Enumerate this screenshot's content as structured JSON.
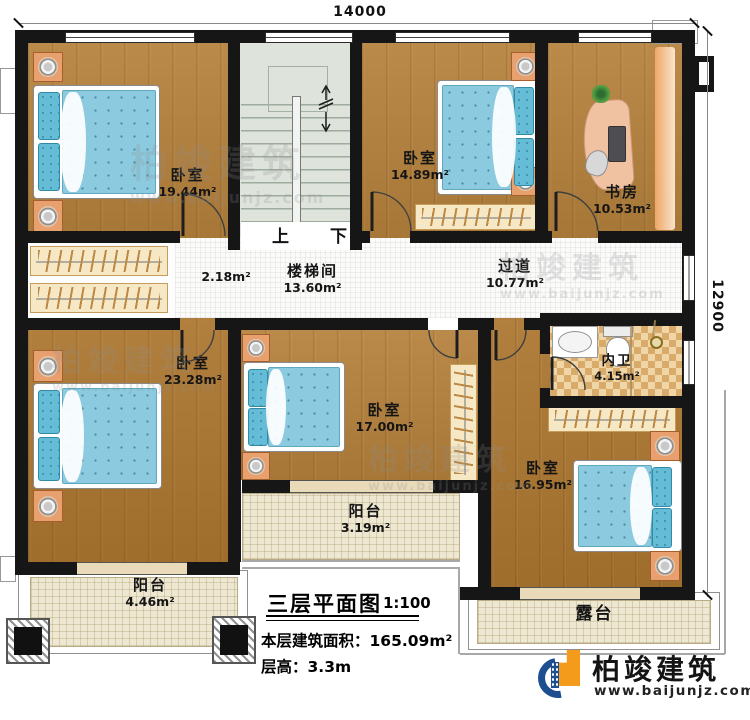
{
  "plan": {
    "dimensions": {
      "width_mm": "14000",
      "height_mm": "12900"
    },
    "rooms": {
      "bedroom_top_left": {
        "name": "卧室",
        "area": "19.44m²"
      },
      "bedroom_top_right": {
        "name": "卧室",
        "area": "14.89m²"
      },
      "study": {
        "name": "书房",
        "area": "10.53m²"
      },
      "stairwell": {
        "name": "楼梯间",
        "area": "13.60m²"
      },
      "hall": {
        "area": "2.18m²"
      },
      "corridor": {
        "name": "过道",
        "area": "10.77m²"
      },
      "bedroom_left": {
        "name": "卧室",
        "area": "23.28m²"
      },
      "bedroom_center": {
        "name": "卧室",
        "area": "17.00m²"
      },
      "bathroom": {
        "name": "内卫",
        "area": "4.15m²"
      },
      "bedroom_bottom_right": {
        "name": "卧室",
        "area": "16.95m²"
      },
      "balcony_center": {
        "name": "阳台",
        "area": "3.19m²"
      },
      "balcony_left": {
        "name": "阳台",
        "area": "4.46m²"
      },
      "terrace": {
        "name": "露台"
      }
    },
    "stairs": {
      "up_label": "上",
      "down_label": "下"
    }
  },
  "title_block": {
    "title": "三层平面图",
    "scale": "1:100",
    "floor_area_label": "本层建筑面积：",
    "floor_area_value": "165.09m²",
    "floor_height_label": "层高：",
    "floor_height_value": "3.3m"
  },
  "branding": {
    "logo_name": "柏竣建筑",
    "logo_url": "www.baijunjz.com"
  },
  "watermark": {
    "name": "柏竣建筑",
    "url": "www.baijunjz.com"
  },
  "colors": {
    "wall": "#161616",
    "wood_floor": "#b5813c",
    "bed": "#8ccbdf",
    "stairs": "#dee3dc",
    "balcony": "#eee8d3",
    "bathroom_tile": "#e7c084",
    "logo_blue": "#1d4e8f",
    "logo_orange": "#f59b1c"
  }
}
